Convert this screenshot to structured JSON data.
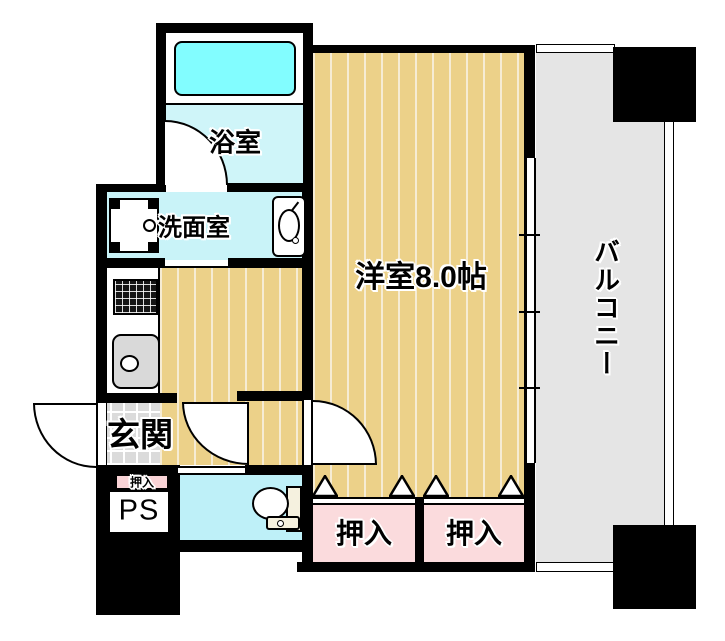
{
  "plan": {
    "rooms": {
      "bathroom": {
        "label": "浴室"
      },
      "washroom": {
        "label": "洗面室"
      },
      "entrance": {
        "label": "玄関"
      },
      "hall_closet": {
        "label": "押入"
      },
      "pipe_space": {
        "label": "PS"
      },
      "main_room": {
        "label": "洋室8.0帖",
        "size_tatami": 8.0
      },
      "closet_left": {
        "label": "押入"
      },
      "closet_right": {
        "label": "押入"
      },
      "balcony": {
        "label": "バルコニー"
      }
    },
    "fixtures": [
      "bathtub",
      "washing-machine-pan",
      "washbasin",
      "gas-stove",
      "kitchen-sink",
      "toilet",
      "entrance-door",
      "bathroom-door",
      "hall-door",
      "room-door",
      "sliding-window",
      "balcony-railing",
      "closet-sliding-doors",
      "closet-door-markers",
      "structural-columns"
    ],
    "colors": {
      "wall": "#000000",
      "wood_floor": "#ECD189",
      "wood_stripe": "#F6ECD4",
      "bathroom_floor": "#CFF5F9",
      "washroom_floor": "#C9F3F8",
      "toilet_floor": "#BEF0F8",
      "bathtub": "#82FDFF",
      "closet_pink": "#FBDBDD",
      "entrance_tile": "#DBDBDB",
      "balcony_gray": "#E5E5E5",
      "sink_gray": "#D9D9D9"
    }
  }
}
